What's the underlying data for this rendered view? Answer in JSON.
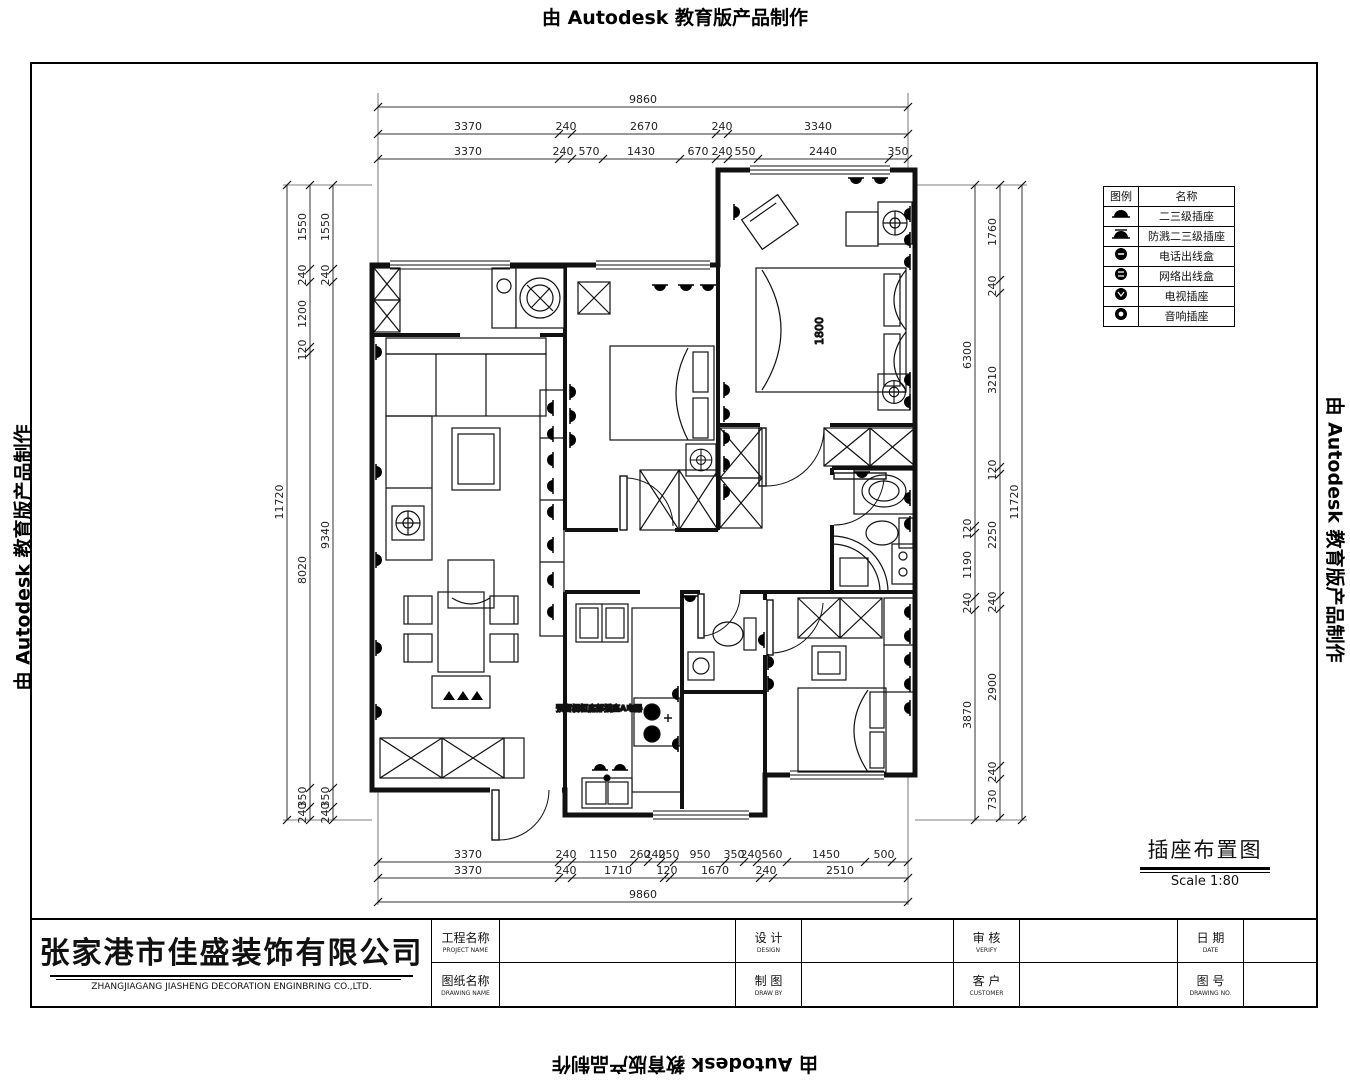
{
  "watermark": {
    "text": "由 Autodesk 教育版产品制作"
  },
  "legend": {
    "header_symbol": "图例",
    "header_name": "名称",
    "rows": [
      {
        "icon": "socket-2-3-level-icon",
        "name": "二三级插座"
      },
      {
        "icon": "splashproof-socket-icon",
        "name": "防溅二三级插座"
      },
      {
        "icon": "phone-outlet-icon",
        "name": "电话出线盒"
      },
      {
        "icon": "network-outlet-icon",
        "name": "网络出线盒"
      },
      {
        "icon": "tv-socket-icon",
        "name": "电视插座"
      },
      {
        "icon": "audio-socket-icon",
        "name": "音响插座"
      }
    ]
  },
  "drawing_title": {
    "name": "插座布置图",
    "scale": "Scale 1:80"
  },
  "title_block": {
    "company_cn": "张家港市佳盛装饰有限公司",
    "company_en": "ZHANGJIAGANG    JIASHENG DECORATION ENGINBRING CO.,LTD.",
    "project_name_cn": "工程名称",
    "project_name_en": "PROJECT NAME",
    "drawing_name_cn": "图纸名称",
    "drawing_name_en": "DRAWING NAME",
    "design_cn": "设 计",
    "design_en": "DESIGN",
    "draw_cn": "制 图",
    "draw_en": "DRAW BY",
    "verify_cn": "审 核",
    "verify_en": "VERIFY",
    "customer_cn": "客 户",
    "customer_en": "CUSTOMER",
    "date_cn": "日 期",
    "date_en": "DATE",
    "drawing_no_cn": "图 号",
    "drawing_no_en": "DRAWING NO."
  },
  "plan": {
    "bed_label": "1800",
    "kitchen_note": "预留橱柜底部插座A电器"
  },
  "dims": {
    "top_total": "9860",
    "top_row2": [
      "3370",
      "240",
      "2670",
      "240",
      "3340"
    ],
    "top_row3": [
      "3370",
      "240",
      "570",
      "1430",
      "670",
      "240",
      "550",
      "2440",
      "350"
    ],
    "bottom_row1": [
      "3370",
      "240",
      "1150",
      "260",
      "240",
      "250",
      "950",
      "350",
      "240",
      "560",
      "1450",
      "500"
    ],
    "bottom_row2": [
      "3370",
      "240",
      "1710",
      "120",
      "1670",
      "240",
      "2510"
    ],
    "bottom_total": "9860",
    "left_total": "11720",
    "left_mid": [
      "1550",
      "240",
      "1200",
      "120",
      "8020",
      "350",
      "240"
    ],
    "left_inner": [
      "1550",
      "240",
      "9340",
      "350",
      "240"
    ],
    "right_total": "11720",
    "right_inner": [
      "6300",
      "120",
      "1190",
      "240",
      "3870"
    ],
    "right_mid": [
      "1760",
      "240",
      "3210",
      "120",
      "2250",
      "240",
      "2900",
      "240",
      "730"
    ]
  }
}
